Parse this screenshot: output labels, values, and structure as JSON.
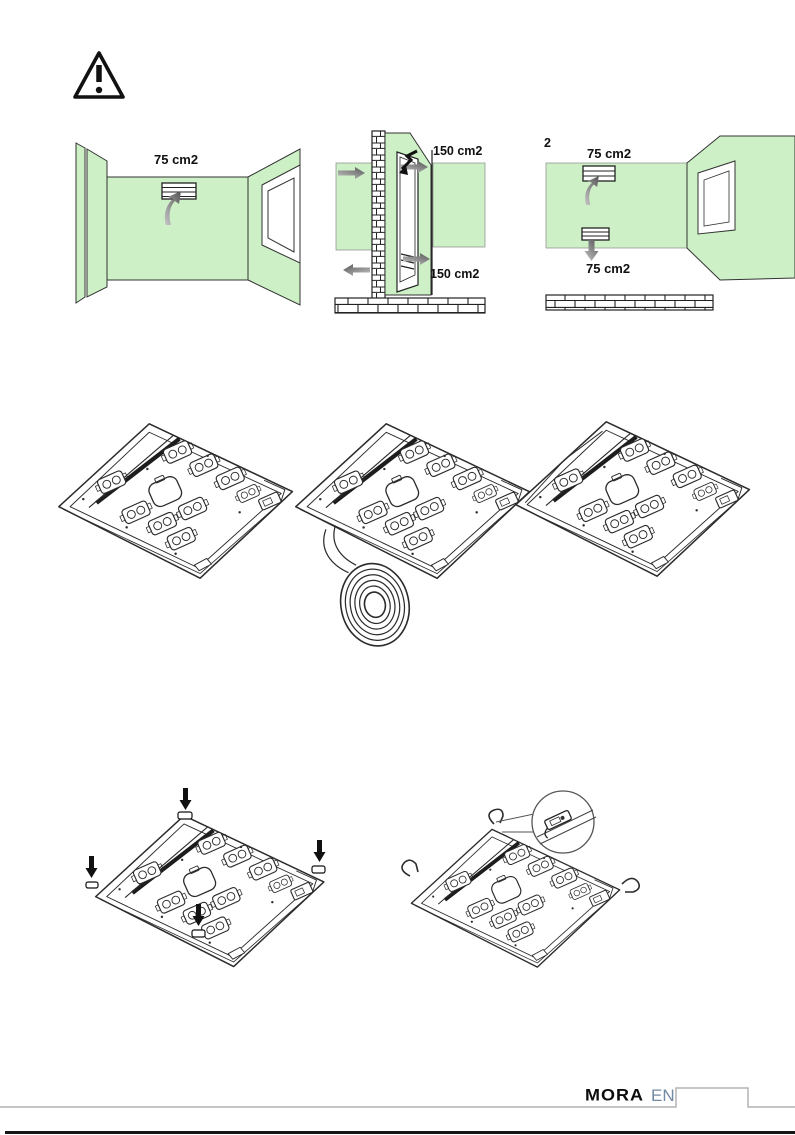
{
  "page": {
    "width": 795,
    "height": 1135,
    "background": "#ffffff"
  },
  "colors": {
    "wall_green": "#cdf0c6",
    "line_art": "#2b2b2b",
    "arrow_gray": "#8a8a8a",
    "tab_gray": "#b3b3b3",
    "brand_black": "#0d0d0d",
    "language_blue": "#7289a2",
    "footer_rule": "#161616"
  },
  "warning": {
    "icon": "warning-triangle-icon",
    "glyph": "!"
  },
  "ventilation_diagrams": {
    "room_high_vent": {
      "label_top": "75 cm2"
    },
    "door_vents": {
      "label_top": "150 cm2",
      "label_bottom": "150 cm2"
    },
    "wall_two_vents": {
      "label_fragment": "2",
      "label_top": "75 cm2",
      "label_bottom": "75 cm2"
    }
  },
  "installation_figures": {
    "hob_underside": "hob-underside-plain",
    "hob_with_seal_roll": "hob-underside-with-seal-tape-roll",
    "hob_underside_alt": "hob-underside-second-view",
    "hob_press_points": "hob-underside-press-clips-arrows",
    "hob_clip_detail": "hob-underside-spring-clip-callout"
  },
  "footer": {
    "brand": "MORA",
    "language": "EN"
  }
}
